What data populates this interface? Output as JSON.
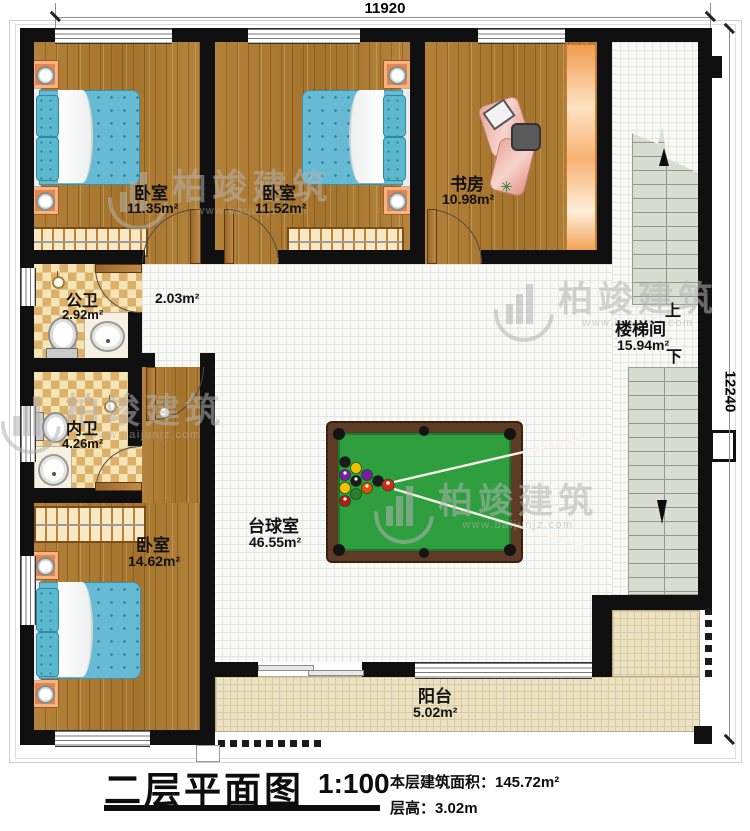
{
  "dimensions": {
    "width_mm": "11920",
    "height_mm": "12240"
  },
  "rooms": {
    "bedroom1": {
      "name": "卧室",
      "area": "11.35m²"
    },
    "bedroom2": {
      "name": "卧室",
      "area": "11.52m²"
    },
    "study": {
      "name": "书房",
      "area": "10.98m²"
    },
    "stairwell": {
      "name": "楼梯间",
      "area": "15.94m²",
      "up_label": "上",
      "down_label": "下"
    },
    "public_bath": {
      "name": "公卫",
      "area": "2.92m²"
    },
    "private_bath": {
      "name": "内卫",
      "area": "4.26m²"
    },
    "hallway": {
      "area": "2.03m²"
    },
    "bedroom3": {
      "name": "卧室",
      "area": "14.62m²"
    },
    "billiard_room": {
      "name": "台球室",
      "area": "46.55m²"
    },
    "balcony": {
      "name": "阳台",
      "area": "5.02m²"
    }
  },
  "title_block": {
    "title": "二层平面图",
    "scale": "1:100",
    "floor_area_label": "本层建筑面积：145.72m²",
    "floor_height_label": "层高：3.02m"
  },
  "watermark": {
    "brand": "柏竣建筑",
    "site": "www.baijunjz.com"
  },
  "colors": {
    "wall": "#101010",
    "wood": "#aa7830",
    "table_frame": "#5d3b24",
    "table_felt": "#2f9e3f",
    "bed": "#66bad4",
    "balcony_tile": "#ebe2c3"
  }
}
